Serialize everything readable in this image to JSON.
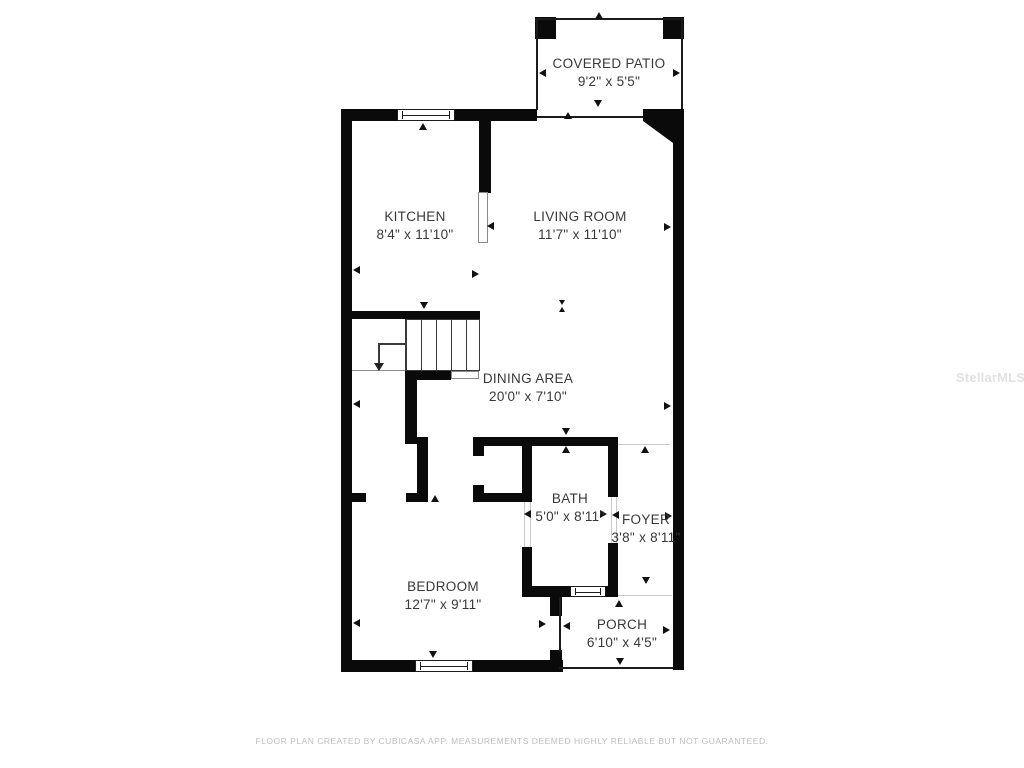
{
  "plan": {
    "type": "floor-plan",
    "background": "#ffffff"
  },
  "rooms": {
    "covered_patio": {
      "name": "COVERED PATIO",
      "dims": "9'2\" x 5'5\""
    },
    "kitchen": {
      "name": "KITCHEN",
      "dims": "8'4\" x 11'10\""
    },
    "living_room": {
      "name": "LIVING ROOM",
      "dims": "11'7\" x 11'10\""
    },
    "dining_area": {
      "name": "DINING AREA",
      "dims": "20'0\" x 7'10\""
    },
    "bath": {
      "name": "BATH",
      "dims": "5'0\" x 8'11\""
    },
    "foyer": {
      "name": "FOYER",
      "dims": "3'8\" x 8'11\""
    },
    "bedroom": {
      "name": "BEDROOM",
      "dims": "12'7\" x 9'11\""
    },
    "porch": {
      "name": "PORCH",
      "dims": "6'10\" x 4'5\""
    }
  },
  "footer": {
    "disclaimer": "FLOOR PLAN CREATED BY CUBICASA APP. MEASUREMENTS DEEMED HIGHLY RELIABLE BUT NOT GUARANTEED."
  },
  "watermark": {
    "text": "StellarMLS"
  },
  "colors": {
    "wall": "#0a0a0a",
    "label_text": "#383838",
    "footer_text": "#bdbdbd",
    "watermark_text": "#e2e2e2"
  }
}
